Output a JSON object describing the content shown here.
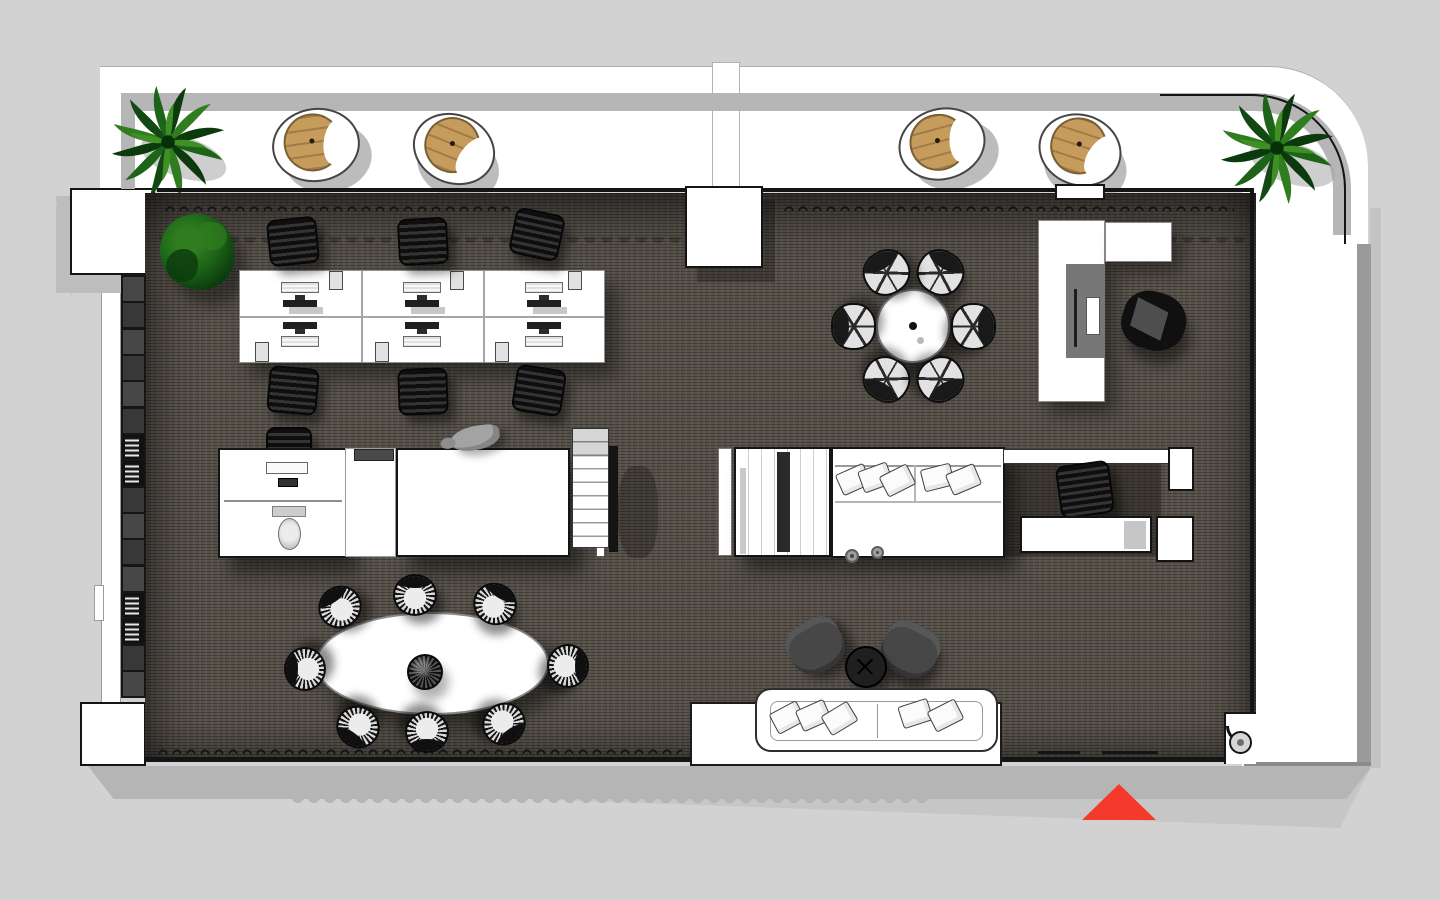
{
  "meta": {
    "scene": "architectural floor plan, top-down 3D render of an office loft with balcony",
    "no_visible_text": true,
    "orientation_marker": "red entrance triangle at bottom right"
  },
  "palette": {
    "bg": "#d2d2d2",
    "white": "#ffffff",
    "wall-shadow": "#b6b6b6",
    "wall-gray": "#9a9a9a",
    "line-black": "#141414",
    "carpet": "#57514a",
    "shelf-dark": "#161616",
    "furn-black": "#1c1c1c",
    "chair-gray": "#474747",
    "basket-tan": "#c59c5c",
    "green-dark": "#0b3a0d",
    "green-mid": "#1d6418",
    "green-light": "#2f7d1f",
    "accent-red": "#f5392b",
    "shadow-gray": "#b5b5b5"
  },
  "inventory": {
    "balcony": {
      "basket_lounge_chairs": 4,
      "palm_plants": 2
    },
    "open_office": {
      "bench_desks": 1,
      "workstations": 6,
      "monitors": 6,
      "task_chairs": 6
    },
    "meeting_area": {
      "round_table": 1,
      "wire_chairs": 6
    },
    "manager_corner": {
      "l_shaped_desk": 1,
      "monitor": 1,
      "lounge_chair": 1
    },
    "core_left": {
      "desk_room": 1,
      "toilet": 1,
      "staircase": 1,
      "sculpture": 1
    },
    "core_right": {
      "wardrobe": 1,
      "banquette_pillows": 5,
      "alcove_chair": 1,
      "alcove_desk": 1
    },
    "dining": {
      "oval_table": 1,
      "wire_chairs": 8,
      "wire_sphere_centerpiece": 1
    },
    "lounge": {
      "sofa": 1,
      "sofa_pillows": 5,
      "armchairs": 2,
      "round_side_table": 1
    },
    "library_wall": {
      "shelf_cells": 16
    },
    "planting": {
      "indoor_shrub": 1
    }
  }
}
